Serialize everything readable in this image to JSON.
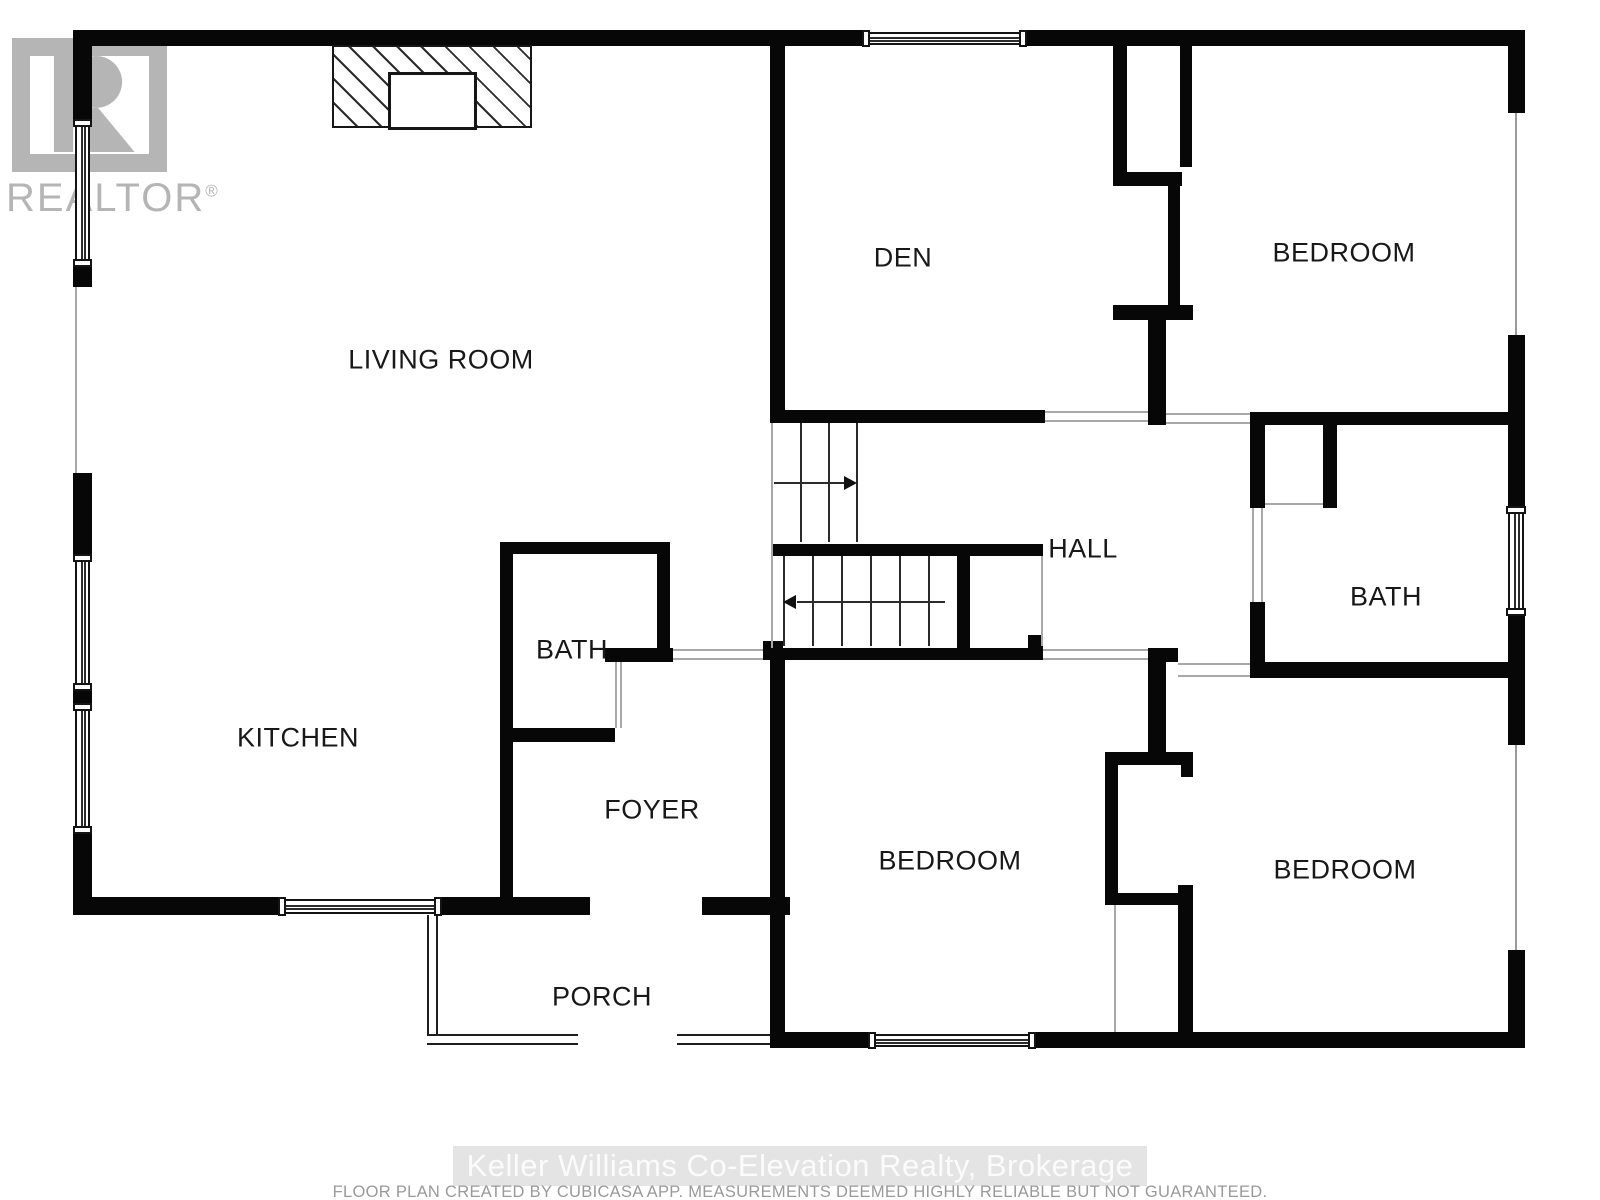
{
  "branding": {
    "logo_text": "REALTOR",
    "registered_mark": "®"
  },
  "rooms": [
    {
      "label": "LIVING ROOM"
    },
    {
      "label": "DEN"
    },
    {
      "label": "BEDROOM"
    },
    {
      "label": "HALL"
    },
    {
      "label": "BATH"
    },
    {
      "label": "KITCHEN"
    },
    {
      "label": "FOYER"
    },
    {
      "label": "BEDROOM"
    },
    {
      "label": "BEDROOM"
    },
    {
      "label": "BATH"
    },
    {
      "label": "PORCH"
    }
  ],
  "footer": {
    "brokerage_watermark": "Keller Williams Co-Elevation Realty, Brokerage",
    "disclaimer": "FLOOR PLAN CREATED BY CUBICASA APP. MEASUREMENTS DEEMED HIGHLY RELIABLE BUT NOT GUARANTEED."
  },
  "colors": {
    "wall": "#070707",
    "logo_gray": "#b5b5b5",
    "watermark_bg": "#e4e4e4",
    "watermark_text": "#fbfbfb",
    "disclaimer_gray": "#9a9a9a"
  }
}
